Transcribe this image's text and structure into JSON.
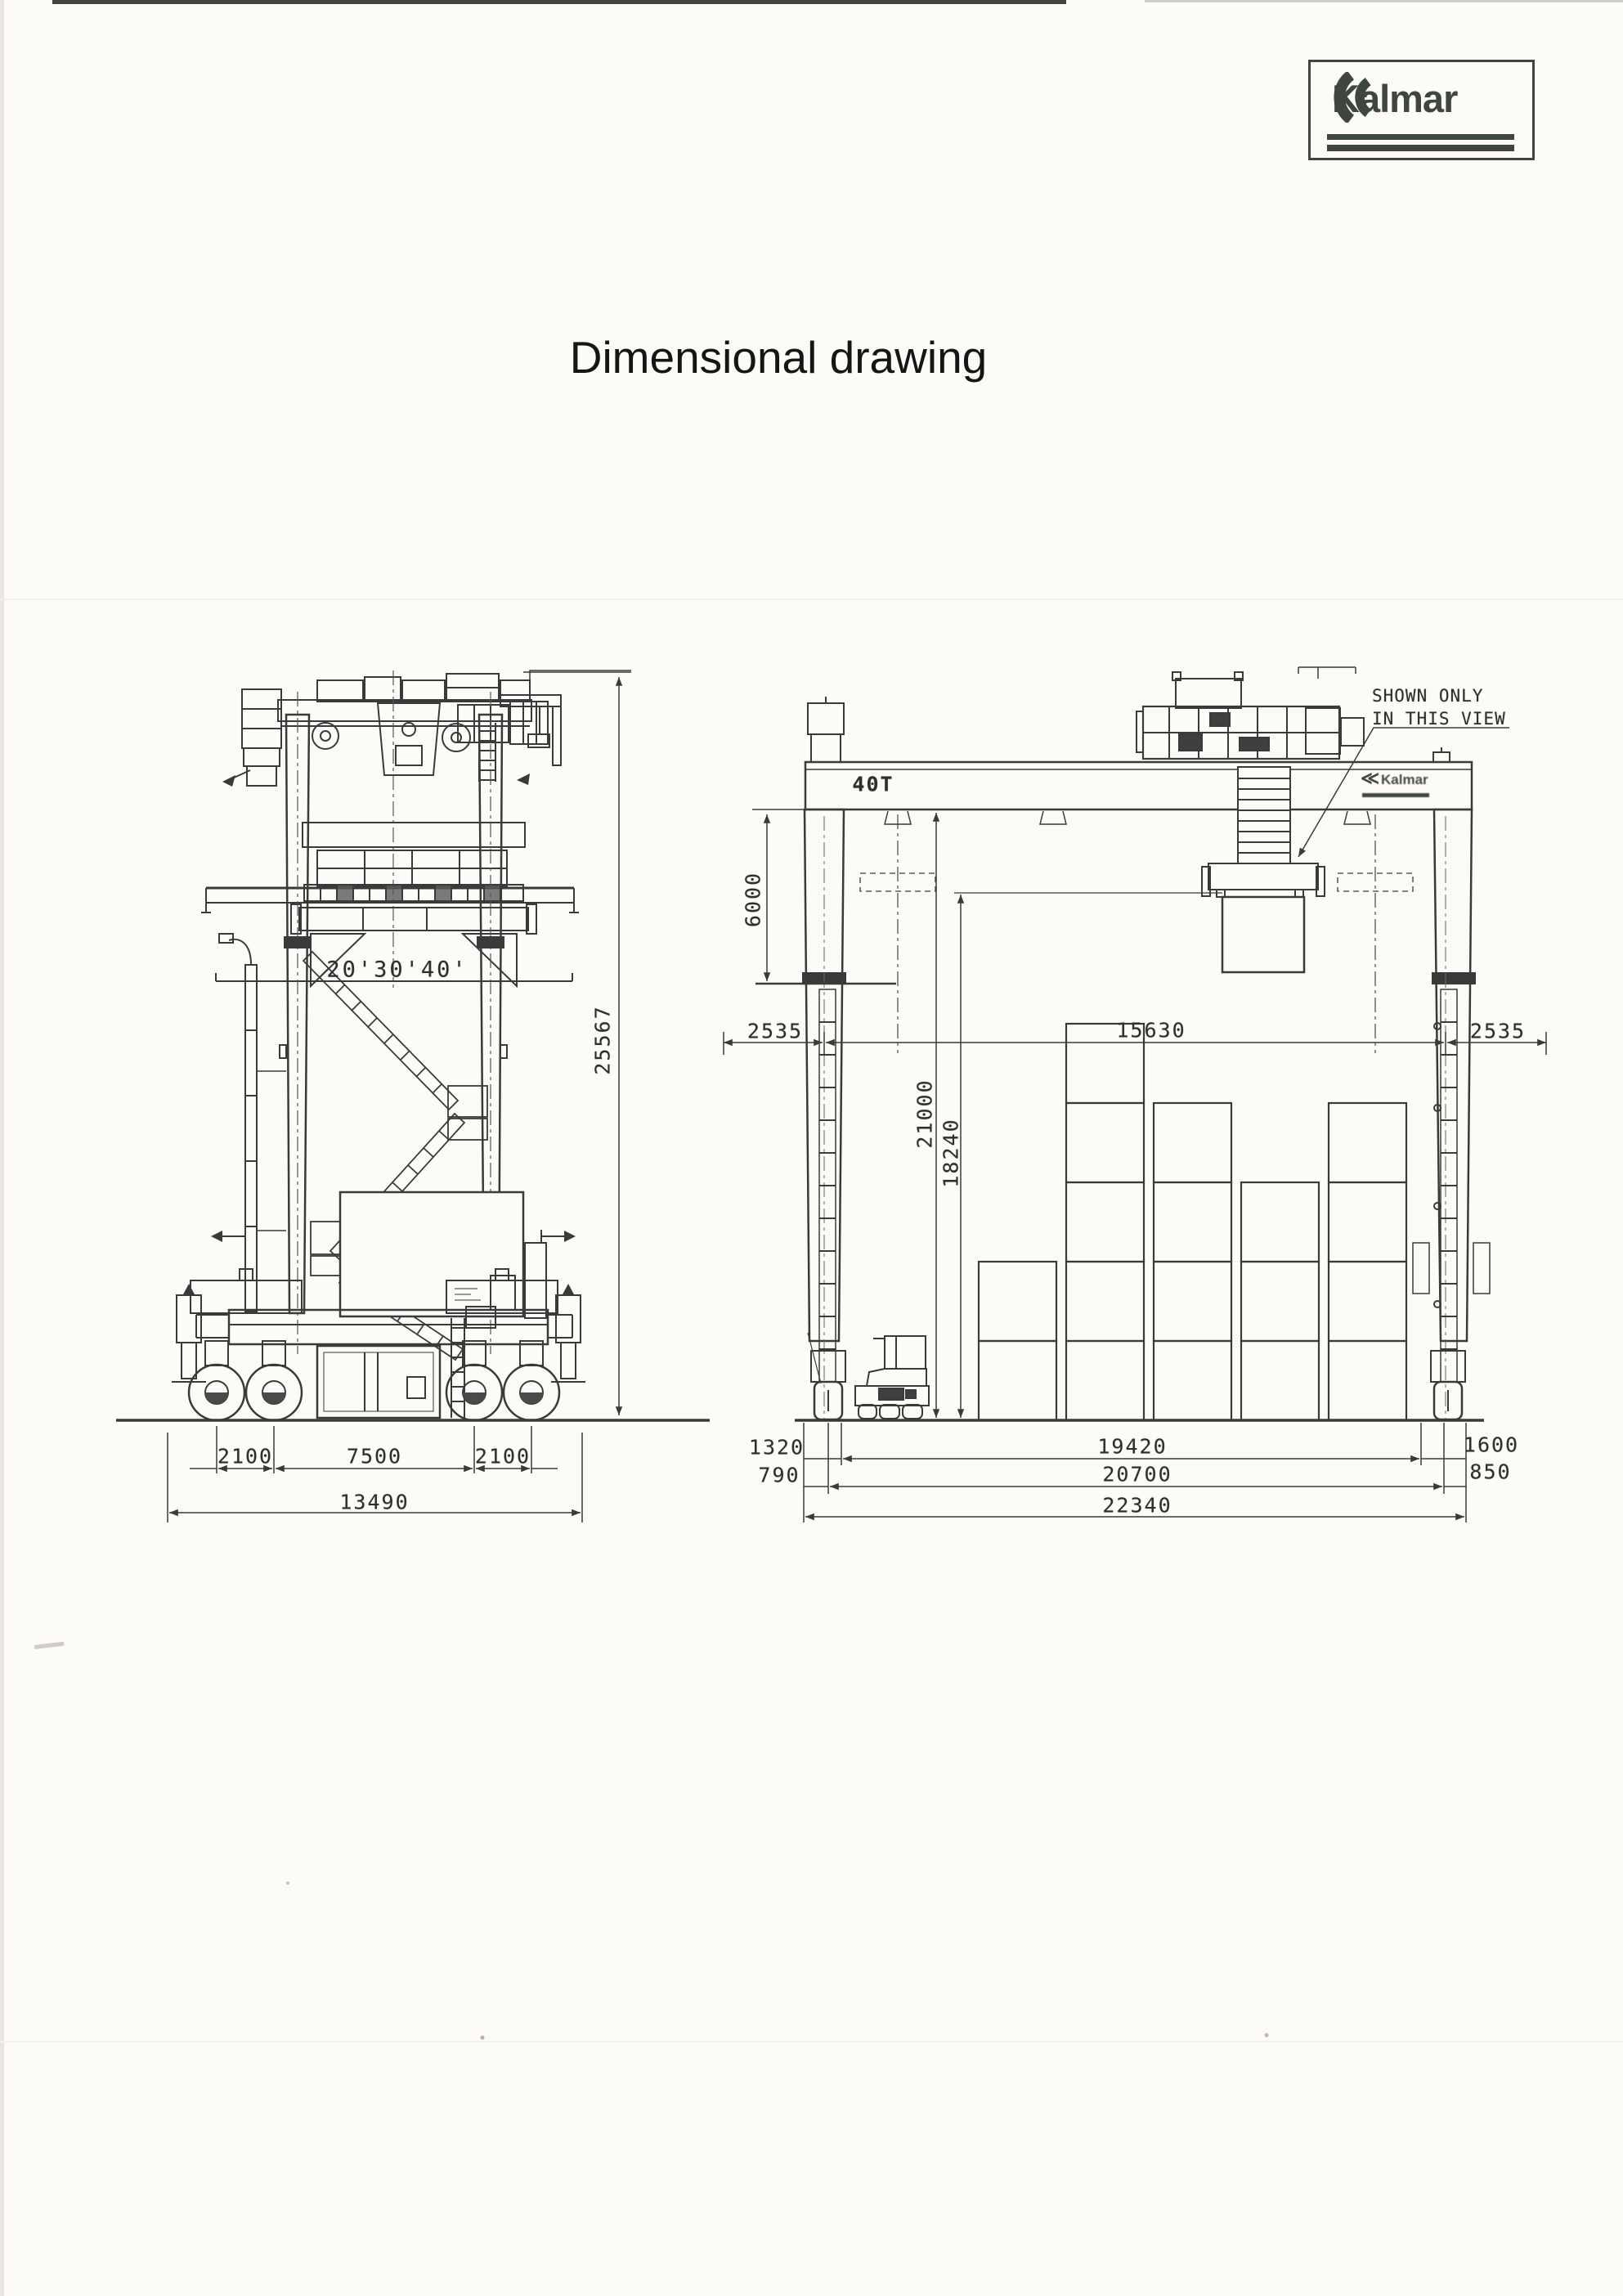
{
  "page": {
    "title_text": "Dimensional drawing"
  },
  "brand": {
    "logo_text": "Kalmar"
  },
  "side_view": {
    "container_sizes_label": "20'30'40'",
    "overall_height": "25567",
    "axle_spacing_left": "2100",
    "wheelbase": "7500",
    "axle_spacing_right": "2100",
    "overall_length": "13490"
  },
  "front_view": {
    "capacity_label": "40T",
    "beam_logo_text": "Kalmar",
    "note_line1": "SHOWN ONLY",
    "note_line2": "IN THIS VIEW",
    "hoist_dimension": "6000",
    "side_clearance_left": "2535",
    "span_inner": "15630",
    "side_clearance_right": "2535",
    "lift_height": "21000",
    "stack_height": "18240",
    "left_offset_top": "1320",
    "left_offset_bottom": "790",
    "rail_span": "19420",
    "outer_span": "20700",
    "overall_width": "22340",
    "right_offset_top": "1600",
    "right_offset_bottom": "850"
  }
}
